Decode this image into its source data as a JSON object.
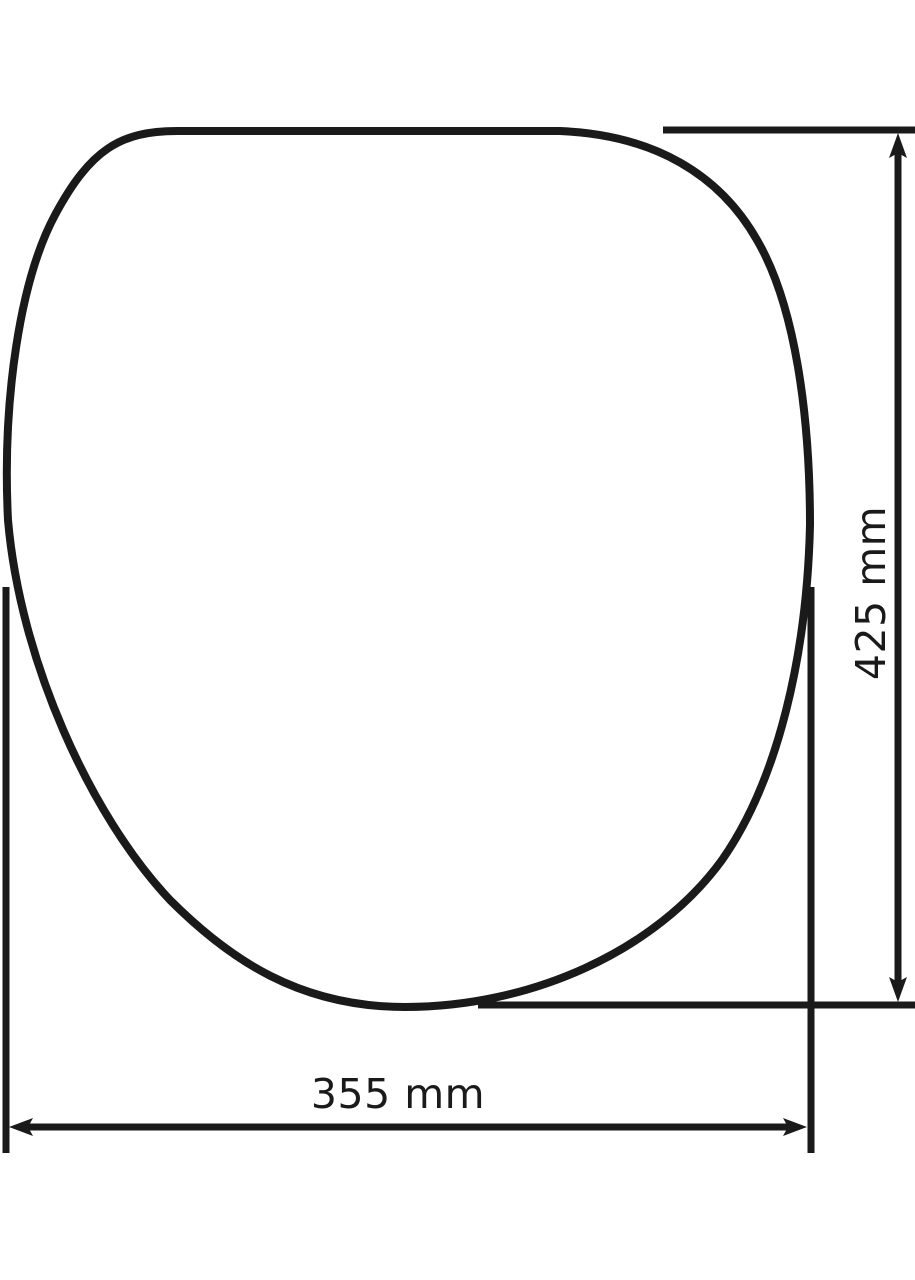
{
  "diagram": {
    "type": "technical-dimension-drawing",
    "subject": "toilet-seat-outline-top-view",
    "background_color": "#ffffff",
    "line_color": "#1a1a1a",
    "dimensions": {
      "height": {
        "label": "425 mm",
        "value": 425,
        "unit": "mm",
        "orientation": "vertical",
        "side": "right"
      },
      "width": {
        "label": "355 mm",
        "value": 355,
        "unit": "mm",
        "orientation": "horizontal",
        "side": "bottom"
      }
    }
  }
}
